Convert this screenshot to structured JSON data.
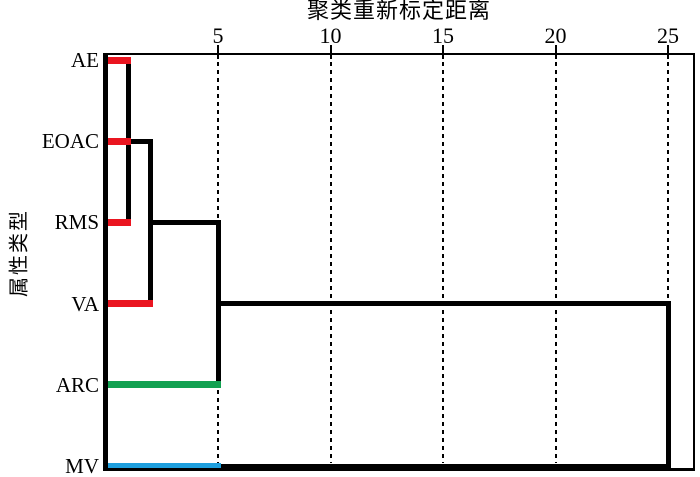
{
  "title": "聚类重新标定距离",
  "y_axis_label": "属性类型",
  "colors": {
    "background": "#FFFFFF",
    "line": "#000000",
    "red": "#EA1520",
    "green": "#12A151",
    "blue": "#1E9FDE"
  },
  "chart_data": {
    "type": "dendrogram",
    "orientation": "horizontal, leaves on left, distance axis on top",
    "title": "聚类重新标定距离",
    "ylabel": "属性类型",
    "xlim": [
      0,
      25
    ],
    "xticks": [
      5,
      10,
      15,
      20,
      25
    ],
    "grid": "dashed vertical gridline at every tick",
    "leaves": [
      "AE",
      "EOAC",
      "RMS",
      "VA",
      "ARC",
      "MV"
    ],
    "leaf_branches": [
      {
        "leaf": "AE",
        "from": 0,
        "to": 1,
        "color": "#EA1520"
      },
      {
        "leaf": "EOAC",
        "from": 0,
        "to": 1,
        "color": "#EA1520"
      },
      {
        "leaf": "RMS",
        "from": 0,
        "to": 1,
        "color": "#EA1520"
      },
      {
        "leaf": "VA",
        "from": 0,
        "to": 2,
        "color": "#EA1520"
      },
      {
        "leaf": "ARC",
        "from": 0,
        "to": 5,
        "color": "#12A151"
      },
      {
        "leaf": "MV",
        "from": 0,
        "to": 5,
        "color": "#1E9FDE"
      }
    ],
    "links": [
      {
        "dir": "v",
        "at": 1,
        "from": "AE",
        "to": "RMS"
      },
      {
        "dir": "h",
        "row": "EOAC",
        "from": 1,
        "to": 2
      },
      {
        "dir": "v",
        "at": 2,
        "from": "EOAC",
        "to": "VA"
      },
      {
        "dir": "h",
        "row": "RMS",
        "from": 2,
        "to": 5
      },
      {
        "dir": "v",
        "at": 5,
        "from": "RMS",
        "to": "ARC"
      },
      {
        "dir": "h",
        "row": "VA",
        "from": 5,
        "to": 25
      },
      {
        "dir": "v",
        "at": 25,
        "from": "VA",
        "to": "MV"
      },
      {
        "dir": "h",
        "row": "MV",
        "from": 5,
        "to": 25
      }
    ],
    "merges": [
      {
        "clusters": [
          "AE",
          "EOAC",
          "RMS"
        ],
        "distance": 1
      },
      {
        "clusters": [
          "{AE,EOAC,RMS}",
          "VA"
        ],
        "distance": 2
      },
      {
        "clusters": [
          "{AE,EOAC,RMS,VA}",
          "ARC"
        ],
        "distance": 5
      },
      {
        "clusters": [
          "{AE,EOAC,RMS,VA,ARC}",
          "MV"
        ],
        "distance": 25
      }
    ]
  }
}
